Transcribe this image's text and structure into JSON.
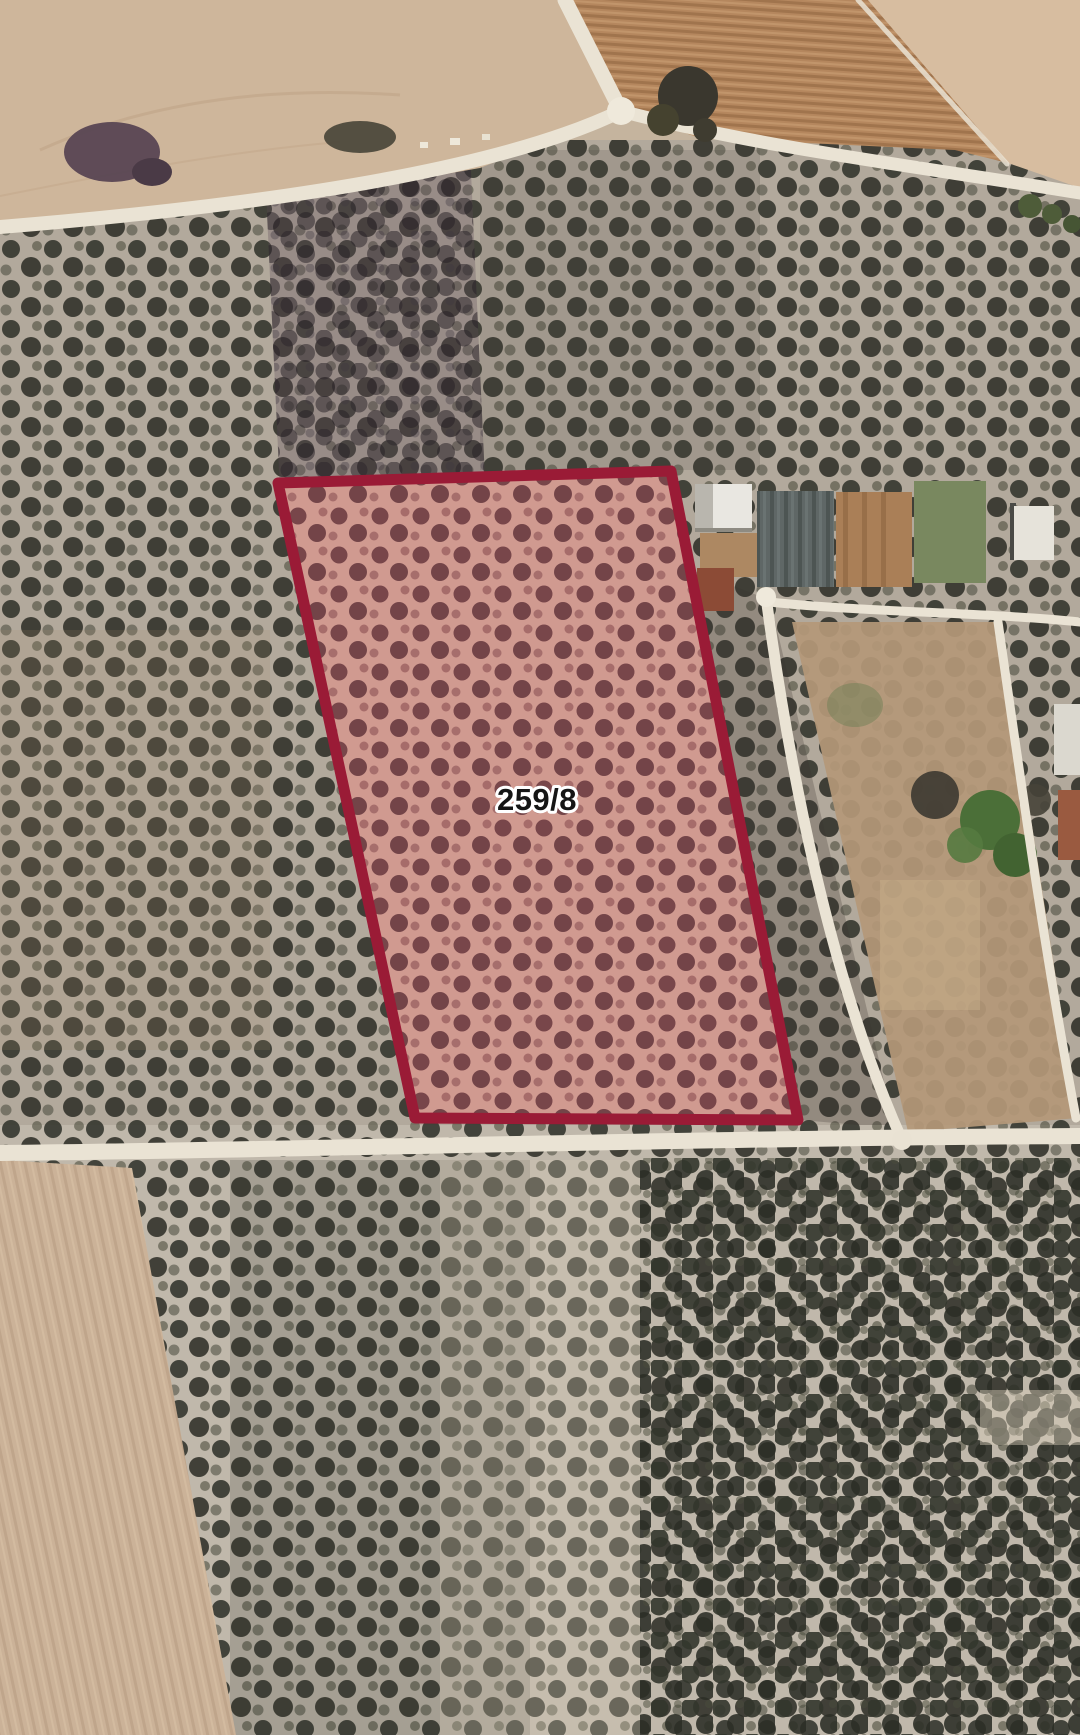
{
  "map": {
    "kind": "satellite-cadastral-map",
    "description": "Aerial imagery of olive orchards, plowed fields, rural tracks and farm buildings with one highlighted cadastral parcel"
  },
  "parcel": {
    "label": "259/8",
    "points": "278,483 671,471 798,1120 415,1118",
    "label_x": "537",
    "label_y": "810",
    "stroke_color": "#9a1b36",
    "fill_soil_color": "#d09a90",
    "tree_dot_color": "#6f3d43",
    "label_text_color": "#151515",
    "label_halo_color": "#ffffff"
  }
}
